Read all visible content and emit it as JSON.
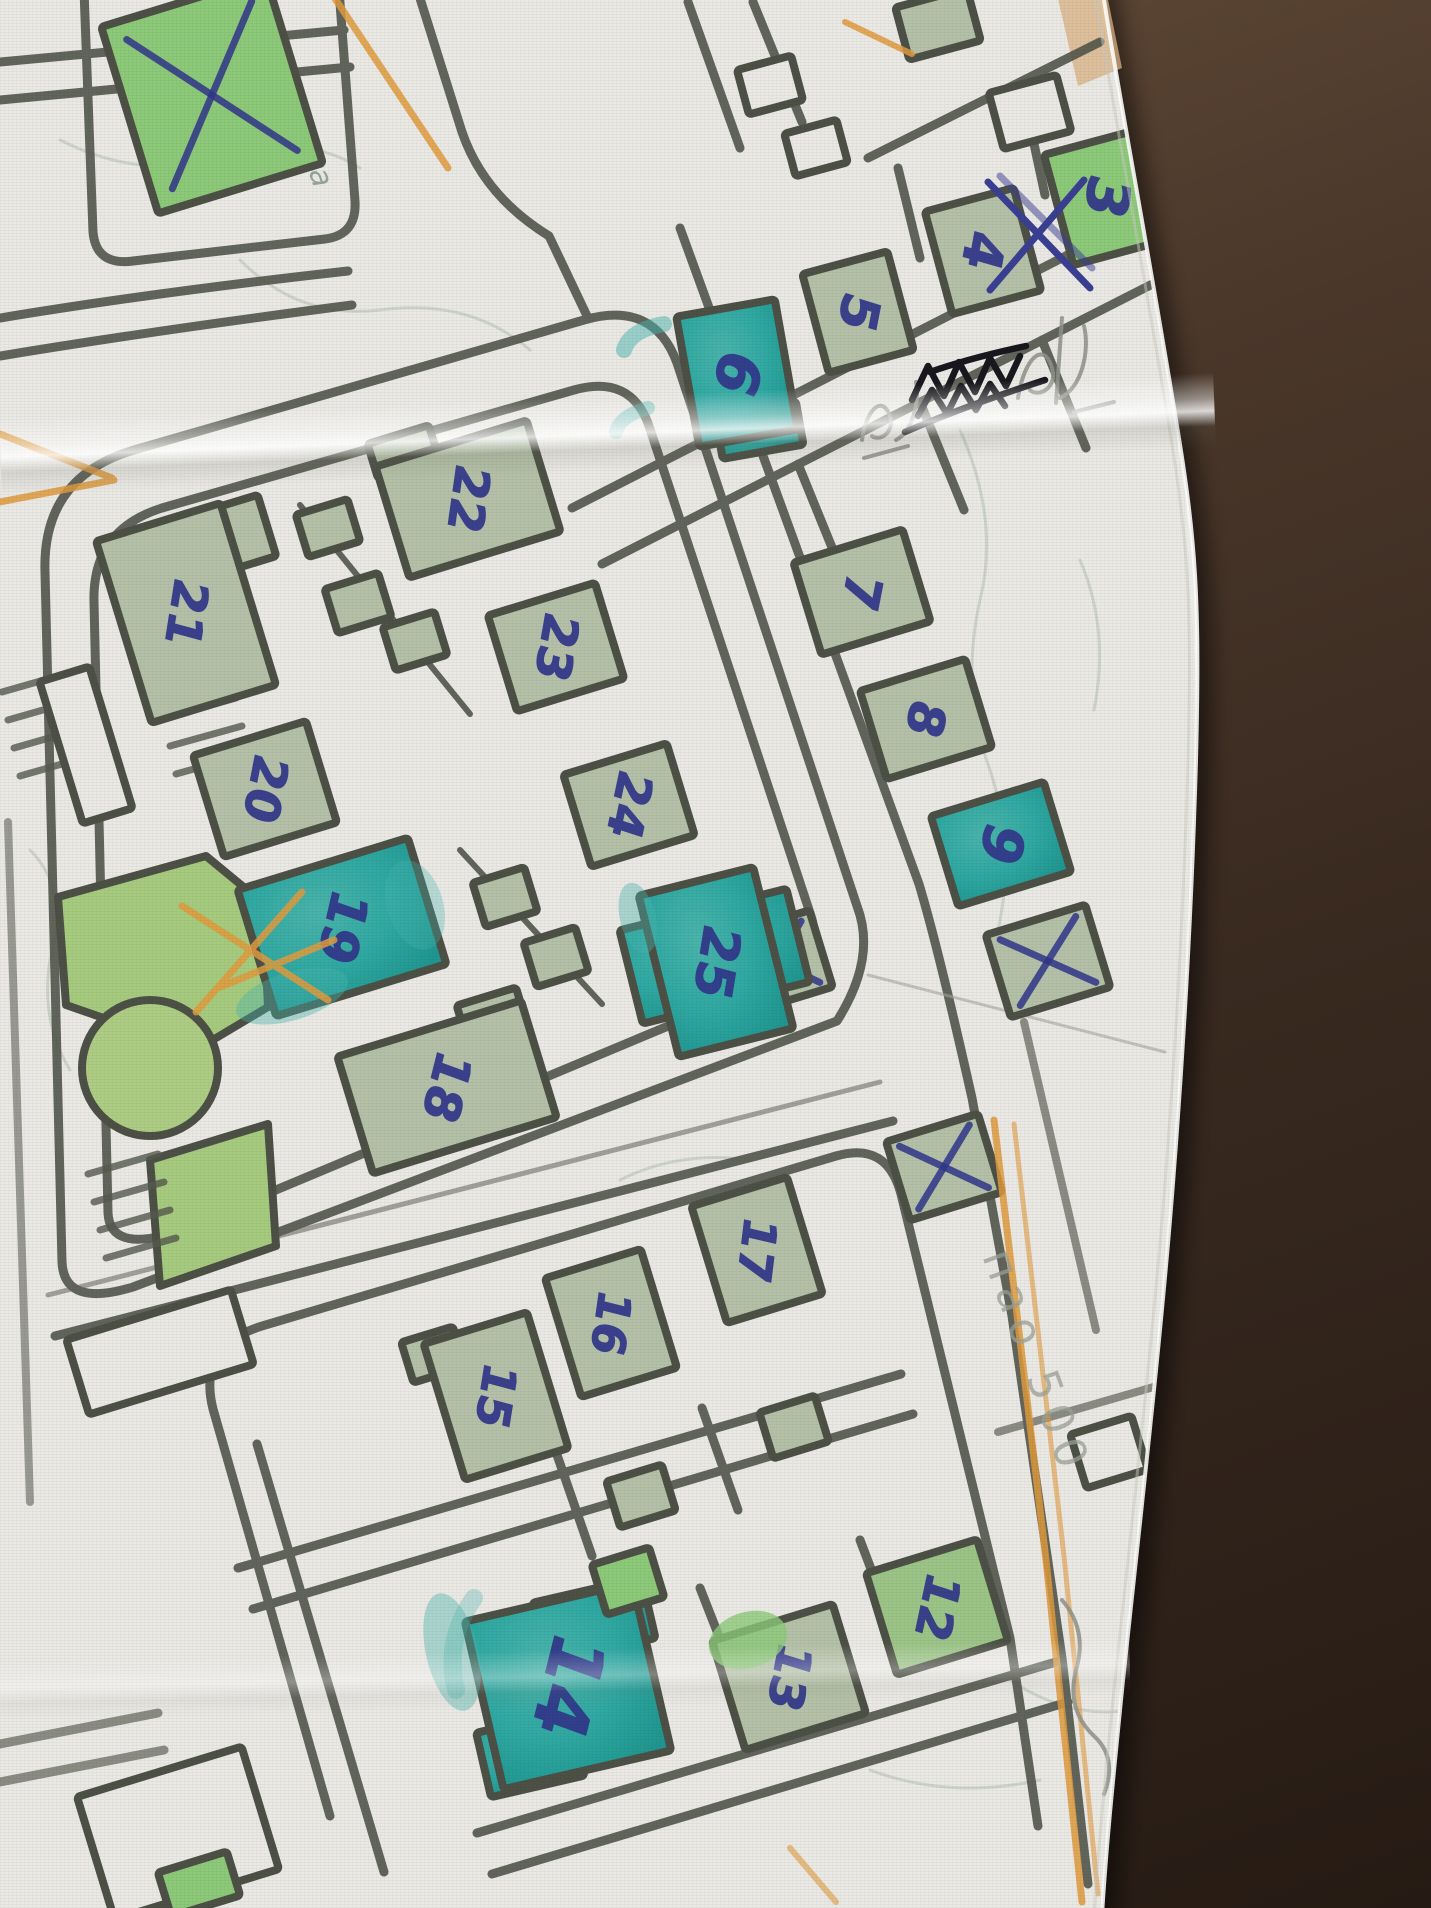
{
  "photo": {
    "surface_color": "#4a392c",
    "paper_color": "#eae9e5",
    "outline_color": "#4c5045",
    "ink_color": "#31368a",
    "pencil_color": "#8f928a",
    "orange_color": "#df9b3e",
    "teal_color": "#2fa8a2",
    "sage_color": "#b4c1a8",
    "green_color": "#8cc979",
    "greensage_color": "#9cc487"
  },
  "map": {
    "street_name": "Сливница",
    "margin_note": "пао 500",
    "buildings": [
      {
        "label": "",
        "cx": 212,
        "cy": 95,
        "w": 172,
        "h": 195,
        "rot": -17,
        "fill": "green",
        "mark": "x"
      },
      {
        "label": "3",
        "cx": 1107,
        "cy": 197,
        "w": 100,
        "h": 114,
        "rot": -15,
        "fill": "green",
        "fs": 58
      },
      {
        "label": "4",
        "cx": 983,
        "cy": 251,
        "w": 92,
        "h": 106,
        "rot": -15,
        "fill": "sage",
        "fs": 54
      },
      {
        "label": "5",
        "cx": 858,
        "cy": 312,
        "w": 88,
        "h": 102,
        "rot": -15,
        "fill": "sage",
        "fs": 52
      },
      {
        "label": "6",
        "cx": 737,
        "cy": 373,
        "w": 100,
        "h": 132,
        "rot": -10,
        "fill": "teal",
        "fs": 60,
        "wings": [
          {
            "dx": 12,
            "dy": 60,
            "w": 82,
            "h": 44
          }
        ]
      },
      {
        "label": "7",
        "cx": 862,
        "cy": 592,
        "w": 114,
        "h": 96,
        "rot": -17,
        "fill": "sage",
        "fs": 50
      },
      {
        "label": "8",
        "cx": 926,
        "cy": 719,
        "w": 110,
        "h": 92,
        "rot": -17,
        "fill": "sage",
        "fs": 50
      },
      {
        "label": "9",
        "cx": 1001,
        "cy": 844,
        "w": 118,
        "h": 94,
        "rot": -17,
        "fill": "teal",
        "fs": 56
      },
      {
        "label": "",
        "cx": 1048,
        "cy": 961,
        "w": 104,
        "h": 86,
        "rot": -17,
        "fill": "sage",
        "mark": "x"
      },
      {
        "label": "",
        "cx": 777,
        "cy": 962,
        "w": 92,
        "h": 80,
        "rot": -17,
        "fill": "sage",
        "mark": "x"
      },
      {
        "label": "",
        "cx": 944,
        "cy": 1167,
        "w": 96,
        "h": 82,
        "rot": -17,
        "fill": "sage",
        "mark": "x"
      },
      {
        "label": "22",
        "cx": 468,
        "cy": 499,
        "w": 158,
        "h": 116,
        "rot": -17,
        "fill": "sage",
        "fs": 48,
        "wings": [
          {
            "dx": -48,
            "dy": -64,
            "w": 64,
            "h": 36
          }
        ]
      },
      {
        "label": "21",
        "cx": 186,
        "cy": 613,
        "w": 130,
        "h": 190,
        "rot": -17,
        "fill": "sage",
        "fs": 48,
        "wings": [
          {
            "dx": 74,
            "dy": -60,
            "w": 58,
            "h": 64
          }
        ]
      },
      {
        "label": "23",
        "cx": 556,
        "cy": 647,
        "w": 112,
        "h": 100,
        "rot": -17,
        "fill": "sage",
        "fs": 48
      },
      {
        "label": "20",
        "cx": 265,
        "cy": 789,
        "w": 118,
        "h": 106,
        "rot": -17,
        "fill": "sage",
        "fs": 48
      },
      {
        "label": "24",
        "cx": 629,
        "cy": 805,
        "w": 108,
        "h": 96,
        "rot": -17,
        "fill": "sage",
        "fs": 48
      },
      {
        "label": "19",
        "cx": 342,
        "cy": 927,
        "w": 178,
        "h": 132,
        "rot": -17,
        "fill": "teal",
        "fs": 52
      },
      {
        "label": "18",
        "cx": 447,
        "cy": 1087,
        "w": 192,
        "h": 122,
        "rot": -17,
        "fill": "sage",
        "fs": 50,
        "wings": [
          {
            "dx": 64,
            "dy": -54,
            "w": 62,
            "h": 42
          }
        ]
      },
      {
        "label": "25",
        "cx": 716,
        "cy": 962,
        "w": 118,
        "h": 166,
        "rot": -14,
        "fill": "teal",
        "fs": 52,
        "wings": [
          {
            "dx": 0,
            "dy": -6,
            "w": 172,
            "h": 96
          }
        ]
      },
      {
        "label": "17",
        "cx": 757,
        "cy": 1250,
        "w": 100,
        "h": 122,
        "rot": -17,
        "fill": "sage",
        "fs": 46
      },
      {
        "label": "16",
        "cx": 611,
        "cy": 1323,
        "w": 100,
        "h": 124,
        "rot": -17,
        "fill": "sage",
        "fs": 46
      },
      {
        "label": "15",
        "cx": 496,
        "cy": 1396,
        "w": 108,
        "h": 142,
        "rot": -17,
        "fill": "sage",
        "fs": 46,
        "wings": [
          {
            "dx": -48,
            "dy": -58,
            "w": 54,
            "h": 42
          }
        ]
      },
      {
        "label": "14",
        "cx": 568,
        "cy": 1686,
        "w": 172,
        "h": 172,
        "rot": -13,
        "fill": "teal",
        "fs": 74,
        "wings": [
          {
            "dx": -52,
            "dy": 58,
            "w": 96,
            "h": 66
          },
          {
            "dx": 40,
            "dy": -58,
            "w": 112,
            "h": 62
          }
        ]
      },
      {
        "label": "13",
        "cx": 789,
        "cy": 1677,
        "w": 126,
        "h": 114,
        "rot": -17,
        "fill": "sage",
        "fs": 48
      },
      {
        "label": "12",
        "cx": 937,
        "cy": 1607,
        "w": 116,
        "h": 106,
        "rot": -17,
        "fill": "greensage",
        "fs": 48
      },
      {
        "label": "",
        "cx": 328,
        "cy": 528,
        "w": 54,
        "h": 44,
        "rot": -17,
        "fill": "sage"
      },
      {
        "label": "",
        "cx": 358,
        "cy": 603,
        "w": 56,
        "h": 46,
        "rot": -17,
        "fill": "sage"
      },
      {
        "label": "",
        "cx": 415,
        "cy": 641,
        "w": 54,
        "h": 45,
        "rot": -17,
        "fill": "sage"
      },
      {
        "label": "",
        "cx": 505,
        "cy": 897,
        "w": 54,
        "h": 46,
        "rot": -17,
        "fill": "sage"
      },
      {
        "label": "",
        "cx": 556,
        "cy": 957,
        "w": 54,
        "h": 46,
        "rot": -17,
        "fill": "sage"
      },
      {
        "label": "",
        "cx": 641,
        "cy": 1496,
        "w": 58,
        "h": 48,
        "rot": -17,
        "fill": "sage"
      },
      {
        "label": "",
        "cx": 794,
        "cy": 1427,
        "w": 58,
        "h": 48,
        "rot": -17,
        "fill": "sage"
      },
      {
        "label": "",
        "cx": 628,
        "cy": 1581,
        "w": 60,
        "h": 52,
        "rot": -17,
        "fill": "green"
      },
      {
        "label": "",
        "cx": 938,
        "cy": 24,
        "w": 74,
        "h": 54,
        "rot": -15,
        "fill": "sage"
      },
      {
        "label": "",
        "cx": 1030,
        "cy": 112,
        "w": 70,
        "h": 58,
        "rot": -15,
        "fill": "paper"
      },
      {
        "label": "",
        "cx": 770,
        "cy": 85,
        "w": 56,
        "h": 46,
        "rot": -15,
        "fill": "paper"
      },
      {
        "label": "",
        "cx": 816,
        "cy": 148,
        "w": 54,
        "h": 44,
        "rot": -15,
        "fill": "paper"
      },
      {
        "label": "",
        "cx": 160,
        "cy": 1352,
        "w": 172,
        "h": 78,
        "rot": -17,
        "fill": "paper"
      },
      {
        "label": "",
        "cx": 178,
        "cy": 1833,
        "w": 172,
        "h": 128,
        "rot": -17,
        "fill": "paper"
      },
      {
        "label": "",
        "cx": 86,
        "cy": 745,
        "w": 52,
        "h": 148,
        "rot": -17,
        "fill": "paper"
      },
      {
        "label": "",
        "cx": 1109,
        "cy": 1452,
        "w": 64,
        "h": 56,
        "rot": -17,
        "fill": "paper"
      },
      {
        "label": "",
        "cx": 199,
        "cy": 1884,
        "w": 72,
        "h": 46,
        "rot": -17,
        "fill": "green"
      }
    ]
  }
}
